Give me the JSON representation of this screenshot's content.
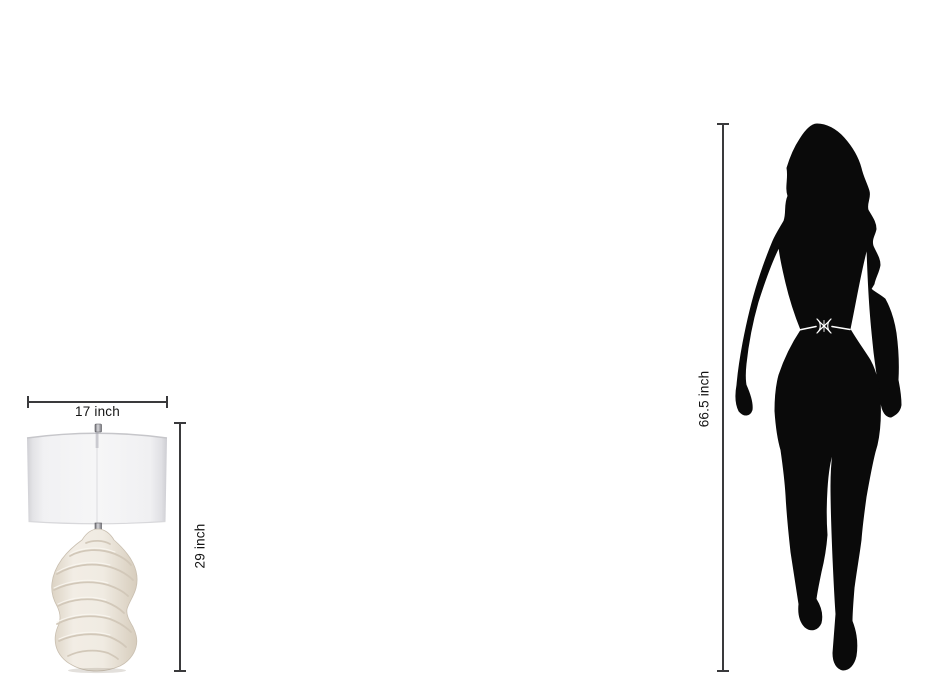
{
  "background": "#ffffff",
  "diagram_type": "product-size-comparison",
  "lamp": {
    "icon": "table-lamp-illustration",
    "description": "sculpted-wave-table-lamp-with-drum-shade",
    "width": {
      "label": "17 inch"
    },
    "height": {
      "label": "29 inch"
    },
    "colors": {
      "shade": "#f2f2f4",
      "shade_edge": "#d5d5d9",
      "shade_rim": "#c6c6ca",
      "base": "#efe9e0",
      "base_ridge": "#d2c8b9",
      "metal": "#8f8f94"
    }
  },
  "person": {
    "icon": "woman-silhouette",
    "description": "female-figure-for-scale",
    "height": {
      "label": "66.5 inch"
    },
    "colors": {
      "silhouette": "#0a0a0a",
      "belt": "#ffffff"
    },
    "belt_icon": "belt-buckle"
  },
  "dimension_style": {
    "line_color": "#3a3a3c",
    "text_color": "#141414"
  }
}
